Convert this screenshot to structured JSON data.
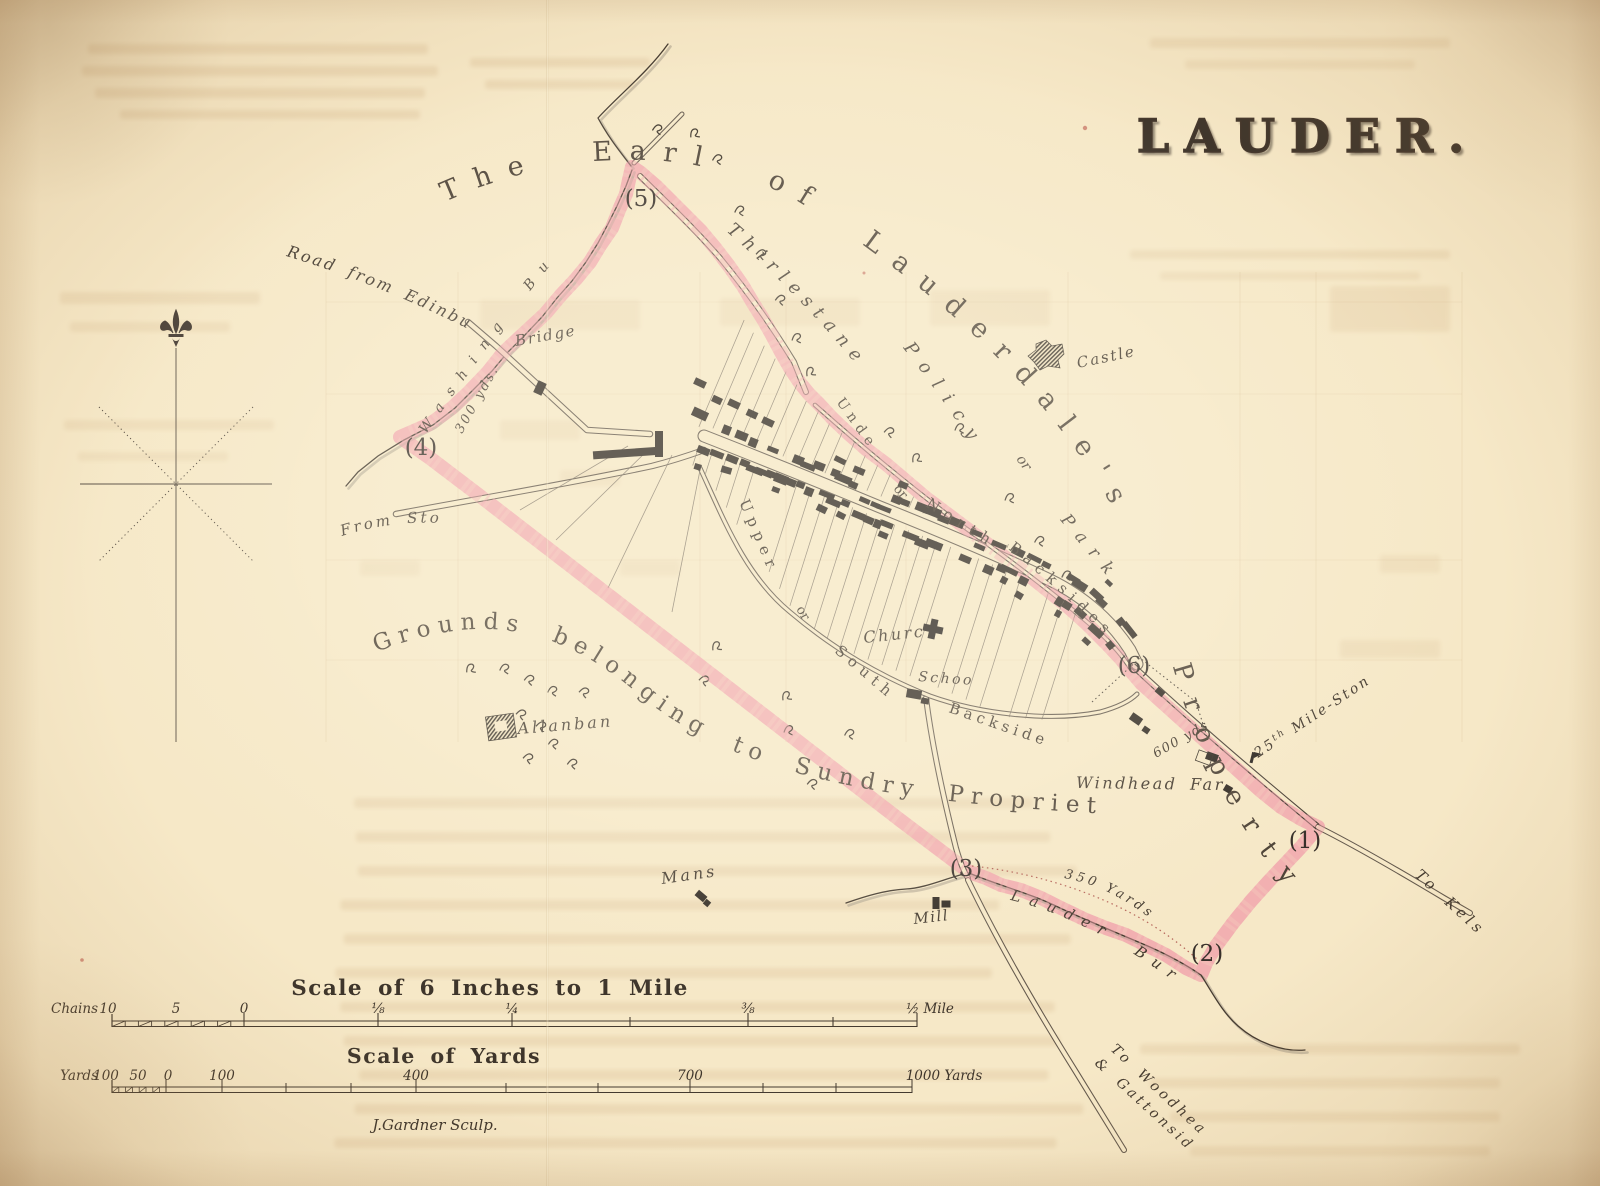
{
  "title": "LAUDER.",
  "estate": {
    "line": "The Earl of Lauderdale's",
    "property": "Property"
  },
  "park": {
    "thirlestane": "Thirlestane",
    "policy": "Policy",
    "or": "or",
    "park": "Park"
  },
  "streets": {
    "north": {
      "w1": "Under",
      "w2": "or",
      "w3": "North",
      "w4": "Backsides"
    },
    "south": {
      "w1": "Upper",
      "w2": "or",
      "w3": "South",
      "w4": "Backsides"
    }
  },
  "grounds": "Grounds belonging to Sundry Proprietors",
  "roads": {
    "edinburgh": "Road from Edinburgh",
    "stow": "From Stow",
    "kelso": "To Kelso",
    "woodhead1": "To Woodhead",
    "woodhead2": "& Gattonside"
  },
  "water": {
    "washing": "Washing Burn",
    "lauder": "Lauder Burn"
  },
  "places": {
    "bridge": "Bridge",
    "castle": "Castle",
    "allanbank": "Allanbank",
    "church": "Church",
    "school": "School",
    "manse": "Manse",
    "mill": "Mill",
    "windhead": "Windhead Farm"
  },
  "distances": {
    "d300": "300 yds.",
    "d600": "600 yds.",
    "d350": "350 Yards",
    "milestone": {
      "num": "25",
      "sup": "th",
      "rest": " Mile-Stone"
    }
  },
  "markers": [
    "(1)",
    "(2)",
    "(3)",
    "(4)",
    "(5)",
    "(6)"
  ],
  "scalebar": {
    "title_mile": "Scale of 6 Inches to 1 Mile",
    "chains_label": "Chains",
    "chains_ticks": [
      "10",
      "5",
      "0",
      "⅛",
      "¼",
      "⅜",
      "½ Mile"
    ],
    "title_yards": "Scale of Yards",
    "yards_label": "Yards",
    "yards_ticks": [
      "100",
      "50",
      "0",
      "100",
      "400",
      "700",
      "1000 Yards"
    ],
    "engraver": "J.Gardner Sculp."
  },
  "colors": {
    "paper": "#f6e8c7",
    "boundary": "#ee8495",
    "ink": "#3b332a"
  }
}
